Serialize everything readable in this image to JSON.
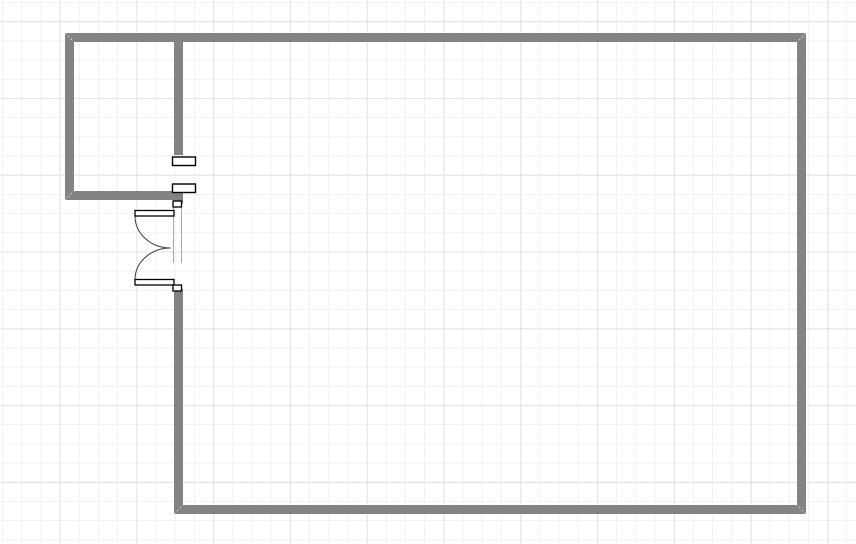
{
  "canvas": {
    "width": 856,
    "height": 544,
    "background": "#ffffff",
    "grid": {
      "minor_spacing": 19.2,
      "major_spacing": 76.8,
      "minor_color": "#f1f1f1",
      "major_color": "#e3e3e3",
      "minor_offset_x": 2,
      "minor_offset_y": 2,
      "major_offset_x": 59.6,
      "major_offset_y": 21.2
    }
  },
  "floorplan": {
    "wall_color": "#838383",
    "wall_thickness": 9,
    "walls": [
      {
        "name": "top-wall",
        "x": 65,
        "y": 33,
        "w": 741,
        "h": 9
      },
      {
        "name": "right-wall",
        "x": 797,
        "y": 33,
        "w": 9,
        "h": 481
      },
      {
        "name": "bottom-wall",
        "x": 174,
        "y": 505,
        "w": 632,
        "h": 9
      },
      {
        "name": "small-room-left-wall",
        "x": 65,
        "y": 33,
        "w": 9,
        "h": 167
      },
      {
        "name": "small-room-bottom-wall",
        "x": 65,
        "y": 191,
        "w": 118,
        "h": 9
      },
      {
        "name": "divider-wall-upper",
        "x": 174,
        "y": 42,
        "w": 9,
        "h": 113
      },
      {
        "name": "divider-wall-stub",
        "x": 174,
        "y": 191,
        "w": 9,
        "h": 13
      },
      {
        "name": "big-room-left-wall",
        "x": 174,
        "y": 289,
        "w": 9,
        "h": 225
      }
    ],
    "corner_seams": {
      "color": "#c9c9c9",
      "dash": "2,2",
      "lines": [
        {
          "x1": 65,
          "y1": 33,
          "x2": 74,
          "y2": 42
        },
        {
          "x1": 806,
          "y1": 33,
          "x2": 797,
          "y2": 42
        },
        {
          "x1": 806,
          "y1": 514,
          "x2": 797,
          "y2": 505
        },
        {
          "x1": 174,
          "y1": 514,
          "x2": 183,
          "y2": 505
        },
        {
          "x1": 65,
          "y1": 200,
          "x2": 74,
          "y2": 191
        }
      ]
    },
    "windows": {
      "stroke": "#000000",
      "fill": "#ffffff",
      "stroke_width": 1.4,
      "items": [
        {
          "name": "window-block-upper",
          "x": 172.5,
          "y": 157,
          "w": 23,
          "h": 8.5
        },
        {
          "name": "window-block-lower",
          "x": 172.5,
          "y": 184,
          "w": 23,
          "h": 8.5
        }
      ]
    },
    "door": {
      "stroke": "#000000",
      "fill": "#ffffff",
      "stroke_width": 1.3,
      "arc_color": "#3b3b3b",
      "jamb_color": "#a8a8a8",
      "frame_blocks": [
        {
          "name": "door-frame-block-top",
          "x": 173,
          "y": 201,
          "w": 8.5,
          "h": 6
        },
        {
          "name": "door-frame-block-bottom",
          "x": 173,
          "y": 285,
          "w": 8.5,
          "h": 6
        }
      ],
      "leaves": [
        {
          "name": "door-leaf-top",
          "x": 135,
          "y": 210.5,
          "w": 39,
          "h": 5.5
        },
        {
          "name": "door-leaf-bottom",
          "x": 135,
          "y": 279.5,
          "w": 39,
          "h": 5.5
        }
      ],
      "swing_arcs": [
        {
          "name": "door-swing-arc-top",
          "d": "M 135 216 A 35.5 32 0 0 0 170.5 248"
        },
        {
          "name": "door-swing-arc-bottom",
          "d": "M 135 279.5 A 35.5 31.5 0 0 1 170.5 248"
        }
      ],
      "jamb_lines": [
        {
          "name": "door-jamb-left",
          "x": 173.5,
          "y1": 206.5,
          "y2": 263
        },
        {
          "name": "door-jamb-right",
          "x": 181.5,
          "y1": 206.5,
          "y2": 263
        }
      ]
    }
  }
}
